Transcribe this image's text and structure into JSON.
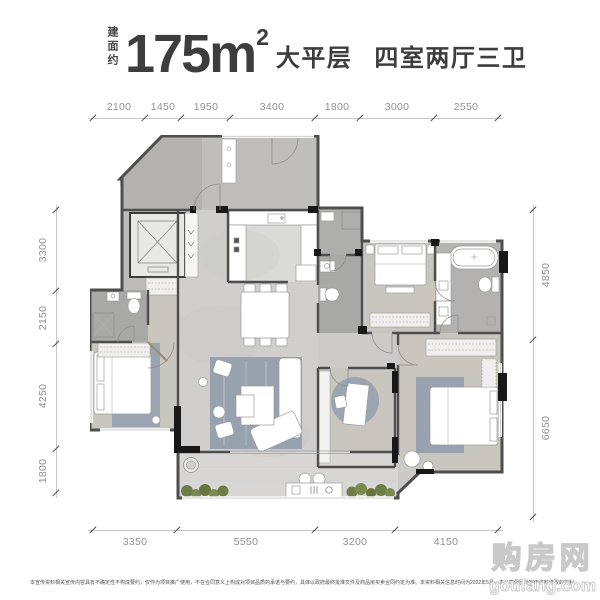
{
  "header": {
    "area_prefix": "建面约",
    "area_value": "175m",
    "area_sup": "2",
    "tag1": "大平层",
    "tag2": "四室两厅三卫"
  },
  "rulers": {
    "top": [
      "2100",
      "1450",
      "1950",
      "3400",
      "1800",
      "3000",
      "2550"
    ],
    "left": [
      "3300",
      "2150",
      "4250",
      "1800"
    ],
    "right": [
      "4850",
      "6650"
    ],
    "bottom": [
      "3350",
      "5550",
      "3200",
      "4150"
    ]
  },
  "watermark": {
    "title": "购房网",
    "domain": "goufang.com"
  },
  "footer": {
    "disclaimer": "本宣传资料相关宣传内容具有不确定性不构成要约，仅作为项目推广使用，不在合同意义上构成对项目品质的承诺与要约，具体以政府最终批准文件及商品房买卖合同约定为准。本资料相关信息时间为2022年5月，本公司保留对宣传资料修改的权利，敬请留意最新资料。"
  },
  "colors": {
    "title_text": "#3d3d3d",
    "dim_text": "#8f8f8f",
    "wall": "#4e4e4e",
    "wall_accent": "#181818",
    "floor_living": "#d0cfcd",
    "floor_wood": "#c9c5bf",
    "floor_bath": "#a8a8a6",
    "rug_blue": "#97a2ae",
    "plant_green": "#6f7e46"
  }
}
